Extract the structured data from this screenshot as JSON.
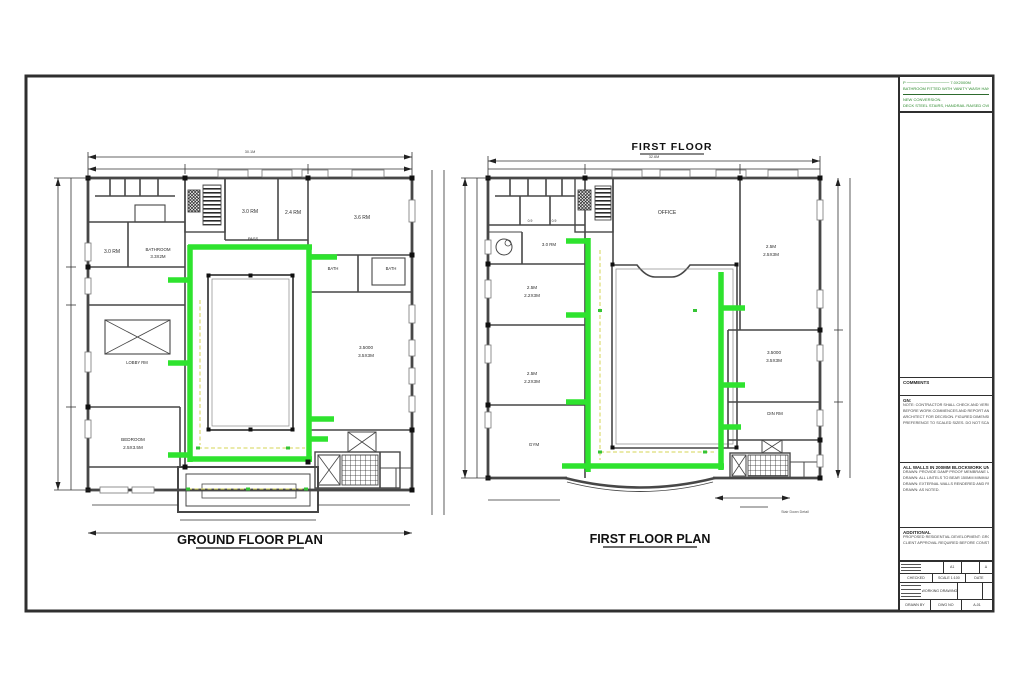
{
  "colors": {
    "highlight_green": "#2ee32e",
    "note_green": "#2e8b2e",
    "wall_gray": "#474747",
    "dash_yellow": "#d6d655"
  },
  "ground_floor": {
    "title": "GROUND FLOOR PLAN",
    "top_dim": "30.1M",
    "rooms": [
      "3.0 RM",
      "2.4 RM",
      "3.6 RM",
      "PASS",
      "3.0 RM",
      "BATHROOM",
      "3.3X2M",
      "BATH",
      "BATH",
      "LOBBY RM",
      "3.5000",
      "3.5X3M",
      "BEDROOM",
      "2.5X3.5M"
    ]
  },
  "first_floor": {
    "heading": "FIRST FLOOR",
    "title": "FIRST FLOOR PLAN",
    "top_dim": "32.6M",
    "rooms": [
      "OFFICE",
      "3.0 RM",
      "2.5M",
      "2.2X3M",
      "2.5M",
      "2.2X3M",
      "GYM",
      "2.5M",
      "2.5X3M",
      "3.5000",
      "3.5X3M",
      "DIN RM"
    ],
    "door_marks": [
      "0.9",
      "0.9"
    ],
    "stair_note": "Stair Down Detail"
  },
  "title_block": {
    "green_notes": {
      "l1": "P ─────────────── 7.0X2000M",
      "l2": "BATHROOM FITTED WITH VANITY WASH HAND BASIN",
      "l3": "NEW CONVERSION.",
      "l4": "DECK STEEL STAIRS, HANDRAIL RAISED OVER 1.0X2.0M"
    },
    "comments_header": "COMMENTS",
    "gn_header": "GN:",
    "gn_lines": {
      "l1": "NOTE: CONTRACTOR SHALL CHECK AND VERIFY ALL DIMENSIONS ON SITE",
      "l2": "BEFORE WORK COMMENCES AND REPORT ANY DISCREPANCY TO THE",
      "l3": "ARCHITECT FOR DECISION. FIGURED DIMENSIONS SHALL BE TAKEN IN",
      "l4": "PREFERENCE TO SCALED SIZES. DO NOT SCALE."
    },
    "spec_header": "ALL WALLS IN 200MM BLOCKWORK UNLESS NOTED OTHERWISE.",
    "spec_lines": {
      "l1": "DRAWN: PROVIDE DAMP PROOF MEMBRANE UNDER GROUND FLOOR SLABS.",
      "l2": "DRAWN: ALL LINTELS TO BEAR 150MM MINIMUM EACH SIDE OF OPENINGS.",
      "l3": "DRAWN: EXTERNAL WALLS RENDERED AND PAINTED AS SPECIFIED.",
      "l4": "DRAWN: AS NOTED."
    },
    "add_header": "ADDITIONAL",
    "add_lines": {
      "l1": "PROPOSED RESIDENTIAL DEVELOPMENT: GROUND AND FIRST FLOOR PLANS",
      "l2": "CLIENT APPROVAL REQUIRED BEFORE CONSTRUCTION       1:100 @ A1"
    },
    "table": {
      "r1c1": "",
      "r1c2": "A1",
      "r1c3": "",
      "r1c4": "Δ",
      "r2c1": "CHECKED",
      "r2c2": "SCALE 1:100",
      "r2c3": "DATE",
      "title_cell": "WORKING DRAWING",
      "r4c1": "DRAWN BY",
      "r4c2": "DWG NO",
      "r4c3": "A-01"
    }
  }
}
